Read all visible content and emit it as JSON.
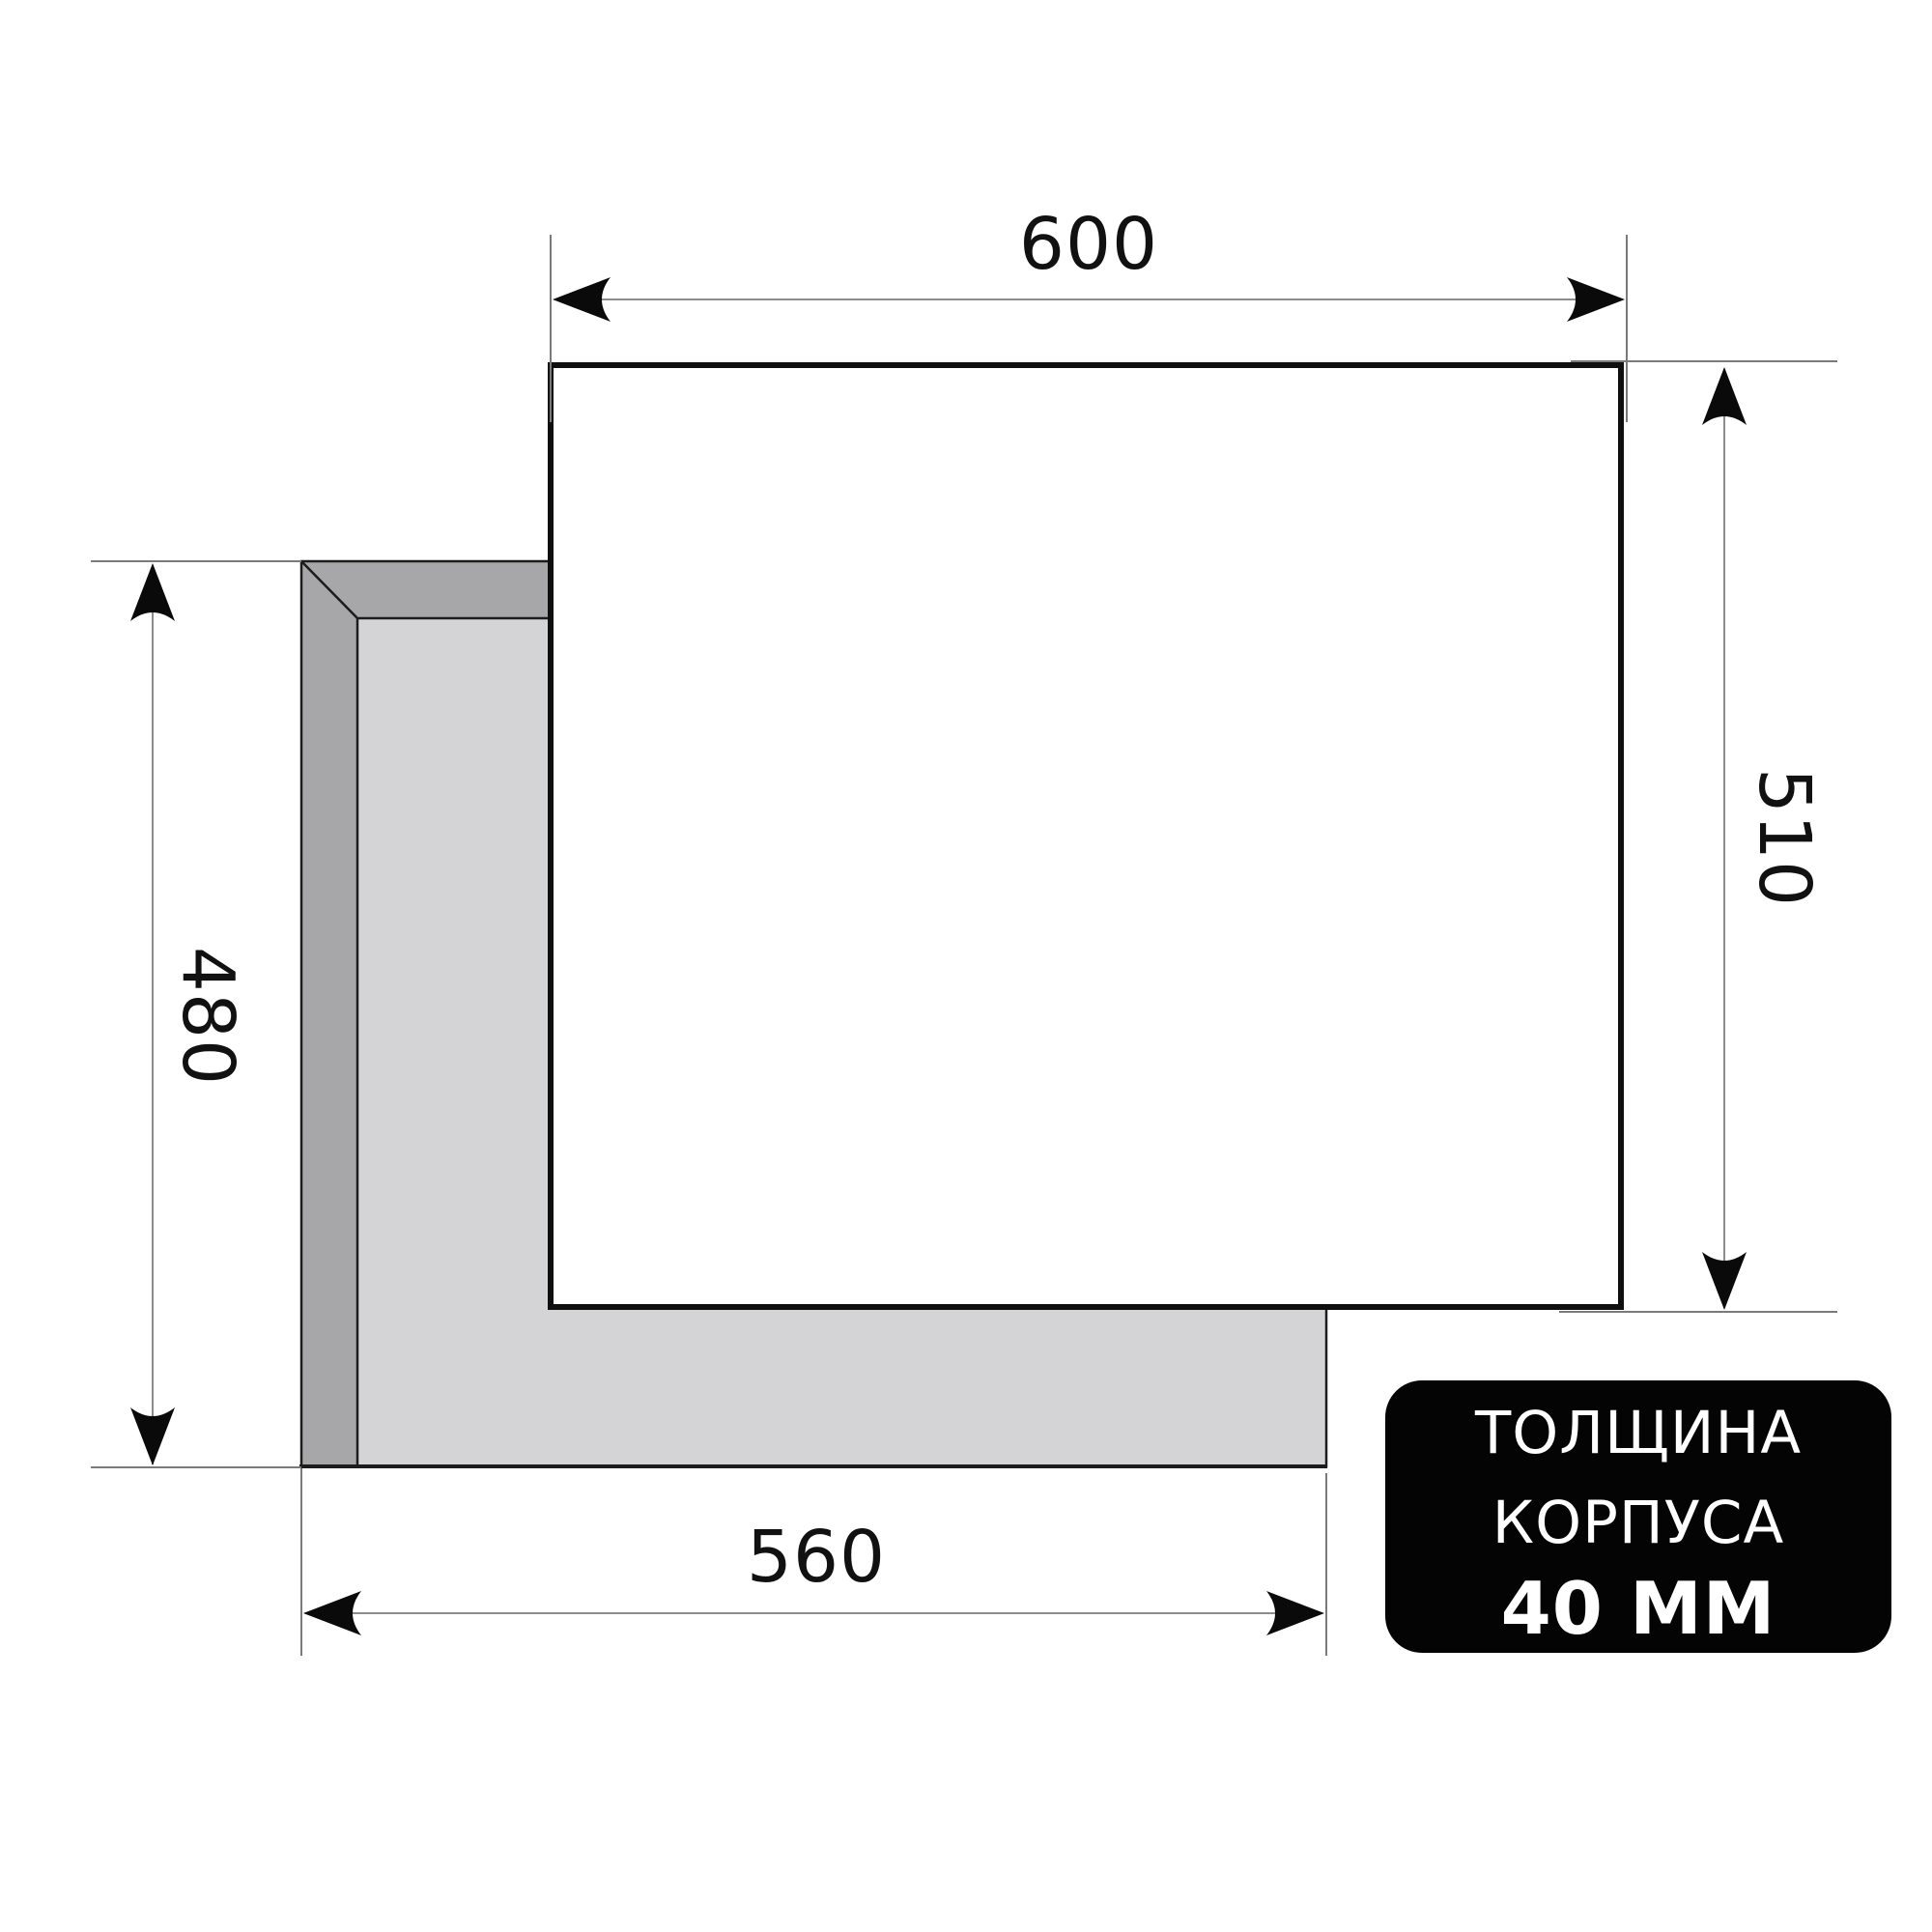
{
  "dimensions": {
    "top_width": {
      "value": "600"
    },
    "right_height": {
      "value": "510"
    },
    "left_height": {
      "value": "480"
    },
    "bottom_width": {
      "value": "560"
    }
  },
  "badge": {
    "line1": "ТОЛЩИНА",
    "line2": "КОРПУСА",
    "line3": "40 ММ",
    "bg_color": "#040404",
    "text_color": "#ffffff"
  },
  "colors": {
    "background": "#ffffff",
    "panel_fill": "#ffffff",
    "panel_stroke": "#0f0f0f",
    "cutout_face": "#d4d4d6",
    "cutout_bevel": "#a7a7aa",
    "edge_line": "#1c1c1c",
    "dim_line": "#8c8c8c",
    "ext_line": "#7a7a7a",
    "arrow": "#0a0a0a",
    "dim_text": "#111111"
  }
}
